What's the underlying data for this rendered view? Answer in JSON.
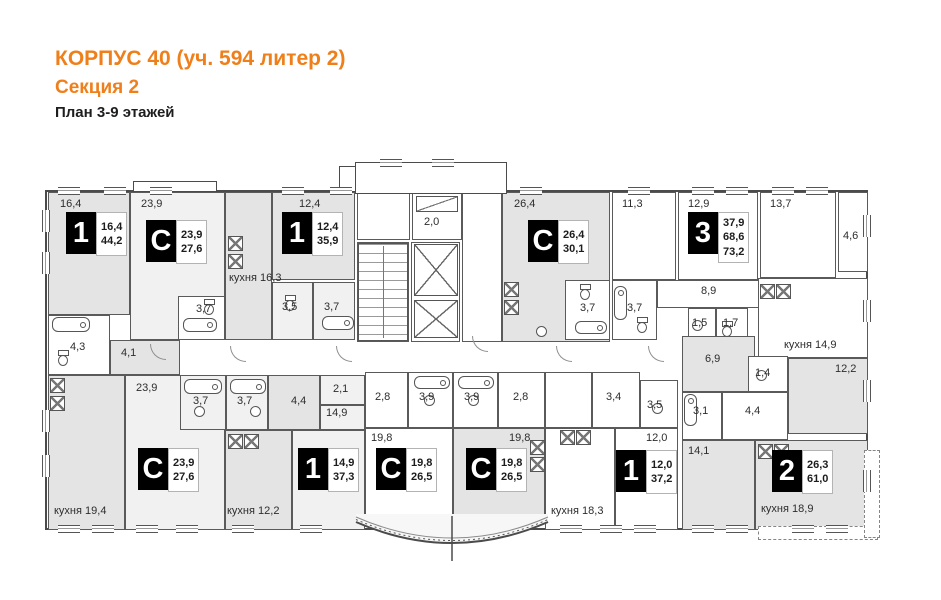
{
  "header": {
    "title": "КОРПУС 40 (уч. 594 литер 2)",
    "subtitle": "Секция 2",
    "caption": "План 3-9 этажей",
    "accent_color": "#EF7F1A"
  },
  "plan": {
    "colors": {
      "wall": "#4b4b4b",
      "room_gray": "#e4e4e4",
      "room_light": "#f1f1f1",
      "room_white": "#ffffff"
    },
    "rooms": [
      {
        "id": "bedroom-16-4",
        "label": "16,4",
        "x": 48,
        "y": 192,
        "w": 82,
        "h": 123,
        "s": "g",
        "lx": 60,
        "ly": 198
      },
      {
        "id": "studio-23-9-living",
        "label": "23,9",
        "x": 130,
        "y": 192,
        "w": 95,
        "h": 148,
        "s": "l",
        "lx": 141,
        "ly": 198
      },
      {
        "id": "studio-23-9-bath",
        "label": "3,7",
        "x": 178,
        "y": 296,
        "w": 47,
        "h": 44,
        "s": "w",
        "lx": 196,
        "ly": 303
      },
      {
        "id": "kitchen-16-3",
        "label": "кухня 16,3",
        "x": 225,
        "y": 192,
        "w": 47,
        "h": 148,
        "s": "g",
        "lx": 229,
        "ly": 272
      },
      {
        "id": "bedroom-12-4",
        "label": "12,4",
        "x": 272,
        "y": 192,
        "w": 83,
        "h": 88,
        "s": "g",
        "lx": 299,
        "ly": 198
      },
      {
        "id": "bath-3-5",
        "label": "3,5",
        "x": 272,
        "y": 282,
        "w": 41,
        "h": 58,
        "s": "l",
        "lx": 282,
        "ly": 301
      },
      {
        "id": "bath-3-7",
        "label": "3,7",
        "x": 313,
        "y": 282,
        "w": 42,
        "h": 58,
        "s": "l",
        "lx": 324,
        "ly": 301
      },
      {
        "id": "stair-vestibule",
        "label": "",
        "x": 357,
        "y": 192,
        "w": 53,
        "h": 48,
        "s": "w"
      },
      {
        "id": "balcony-2-0",
        "label": "2,0",
        "x": 412,
        "y": 192,
        "w": 50,
        "h": 48,
        "s": "w",
        "lx": 424,
        "ly": 216
      },
      {
        "id": "stairwell",
        "label": "",
        "x": 357,
        "y": 242,
        "w": 52,
        "h": 100,
        "s": "w"
      },
      {
        "id": "elevator-hall",
        "label": "",
        "x": 411,
        "y": 242,
        "w": 49,
        "h": 100,
        "s": "w"
      },
      {
        "id": "entrance-lobby",
        "label": "",
        "x": 462,
        "y": 192,
        "w": 40,
        "h": 150,
        "s": "w"
      },
      {
        "id": "studio-26-4-living",
        "label": "26,4",
        "x": 502,
        "y": 192,
        "w": 108,
        "h": 150,
        "s": "g",
        "lx": 514,
        "ly": 198
      },
      {
        "id": "studio-26-4-bath",
        "label": "3,7",
        "x": 565,
        "y": 280,
        "w": 45,
        "h": 60,
        "s": "w",
        "lx": 580,
        "ly": 302
      },
      {
        "id": "bath-3-7-apt3",
        "label": "3,7",
        "x": 612,
        "y": 280,
        "w": 45,
        "h": 60,
        "s": "w",
        "lx": 627,
        "ly": 302
      },
      {
        "id": "room-11-3",
        "label": "11,3",
        "x": 612,
        "y": 192,
        "w": 64,
        "h": 88,
        "s": "w",
        "lx": 622,
        "ly": 198
      },
      {
        "id": "room-12-9",
        "label": "12,9",
        "x": 678,
        "y": 192,
        "w": 80,
        "h": 88,
        "s": "w",
        "lx": 688,
        "ly": 198
      },
      {
        "id": "room-13-7",
        "label": "13,7",
        "x": 760,
        "y": 192,
        "w": 76,
        "h": 86,
        "s": "w",
        "lx": 770,
        "ly": 198
      },
      {
        "id": "balcony-4-6",
        "label": "4,6",
        "x": 838,
        "y": 192,
        "w": 30,
        "h": 80,
        "s": "w",
        "lx": 843,
        "ly": 230
      },
      {
        "id": "hall-8-9",
        "label": "8,9",
        "x": 657,
        "y": 280,
        "w": 115,
        "h": 28,
        "s": "w",
        "lx": 701,
        "ly": 285
      },
      {
        "id": "wc-1-5",
        "label": "1,5",
        "x": 688,
        "y": 308,
        "w": 28,
        "h": 36,
        "s": "w",
        "lx": 692,
        "ly": 317
      },
      {
        "id": "bath-1-7",
        "label": "1,7",
        "x": 716,
        "y": 308,
        "w": 32,
        "h": 36,
        "s": "w",
        "lx": 723,
        "ly": 317
      },
      {
        "id": "kitchen-14-9",
        "label": "кухня 14,9",
        "x": 758,
        "y": 278,
        "w": 110,
        "h": 80,
        "s": "w",
        "lx": 784,
        "ly": 339
      },
      {
        "id": "room-12-2",
        "label": "12,2",
        "x": 788,
        "y": 358,
        "w": 80,
        "h": 76,
        "s": "g",
        "lx": 835,
        "ly": 363
      },
      {
        "id": "kitchen-19-4",
        "label": "кухня 19,4",
        "x": 48,
        "y": 375,
        "w": 77,
        "h": 155,
        "s": "g",
        "lx": 54,
        "ly": 505
      },
      {
        "id": "bath-4-3",
        "label": "4,3",
        "x": 48,
        "y": 315,
        "w": 62,
        "h": 60,
        "s": "w",
        "lx": 70,
        "ly": 341
      },
      {
        "id": "hall-4-1",
        "label": "4,1",
        "x": 110,
        "y": 340,
        "w": 70,
        "h": 35,
        "s": "g",
        "lx": 121,
        "ly": 347
      },
      {
        "id": "studio2-23-9-living",
        "label": "23,9",
        "x": 125,
        "y": 375,
        "w": 100,
        "h": 155,
        "s": "l",
        "lx": 136,
        "ly": 382
      },
      {
        "id": "studio2-23-9-bath",
        "label": "3,7",
        "x": 180,
        "y": 375,
        "w": 46,
        "h": 55,
        "s": "l",
        "lx": 193,
        "ly": 395
      },
      {
        "id": "bath-3-7b",
        "label": "3,7",
        "x": 226,
        "y": 375,
        "w": 42,
        "h": 55,
        "s": "l",
        "lx": 237,
        "ly": 395
      },
      {
        "id": "hall-4-4",
        "label": "4,4",
        "x": 268,
        "y": 375,
        "w": 52,
        "h": 55,
        "s": "g",
        "lx": 291,
        "ly": 395
      },
      {
        "id": "niche-2-1",
        "label": "2,1",
        "x": 320,
        "y": 375,
        "w": 45,
        "h": 30,
        "s": "l",
        "lx": 333,
        "ly": 383
      },
      {
        "id": "room-14-9-upper",
        "label": "14,9",
        "x": 320,
        "y": 405,
        "w": 45,
        "h": 25,
        "s": "l",
        "lx": 326,
        "ly": 407
      },
      {
        "id": "bedroom-14-9",
        "label": "",
        "x": 292,
        "y": 430,
        "w": 73,
        "h": 100,
        "s": "l"
      },
      {
        "id": "kitchen-12-2",
        "label": "кухня 12,2",
        "x": 225,
        "y": 430,
        "w": 67,
        "h": 100,
        "s": "g",
        "lx": 227,
        "ly": 505
      },
      {
        "id": "studioA-hall",
        "label": "2,8",
        "x": 365,
        "y": 372,
        "w": 43,
        "h": 56,
        "s": "w",
        "lx": 375,
        "ly": 391
      },
      {
        "id": "studioA-bath",
        "label": "3,9",
        "x": 408,
        "y": 372,
        "w": 45,
        "h": 56,
        "s": "w",
        "lx": 419,
        "ly": 391
      },
      {
        "id": "studioA-living",
        "label": "19,8",
        "x": 365,
        "y": 428,
        "w": 88,
        "h": 96,
        "s": "w",
        "lx": 371,
        "ly": 432
      },
      {
        "id": "studioB-bath",
        "label": "3,9",
        "x": 453,
        "y": 372,
        "w": 45,
        "h": 56,
        "s": "w",
        "lx": 464,
        "ly": 391
      },
      {
        "id": "studioB-hall",
        "label": "2,8",
        "x": 498,
        "y": 372,
        "w": 47,
        "h": 56,
        "s": "w",
        "lx": 513,
        "ly": 391
      },
      {
        "id": "studioB-living",
        "label": "19,8",
        "x": 453,
        "y": 428,
        "w": 92,
        "h": 96,
        "s": "g",
        "lx": 509,
        "ly": 432
      },
      {
        "id": "apt-entry",
        "label": "",
        "x": 545,
        "y": 372,
        "w": 47,
        "h": 56,
        "s": "w"
      },
      {
        "id": "hall-3-4",
        "label": "3,4",
        "x": 592,
        "y": 372,
        "w": 48,
        "h": 56,
        "s": "w",
        "lx": 606,
        "ly": 391
      },
      {
        "id": "bath-3-5b",
        "label": "3,5",
        "x": 640,
        "y": 380,
        "w": 38,
        "h": 48,
        "s": "w",
        "lx": 647,
        "ly": 399
      },
      {
        "id": "kitchen-18-3",
        "label": "кухня 18,3",
        "x": 545,
        "y": 428,
        "w": 70,
        "h": 102,
        "s": "w",
        "lx": 551,
        "ly": 505
      },
      {
        "id": "bedroom-12-0",
        "label": "12,0",
        "x": 615,
        "y": 428,
        "w": 63,
        "h": 102,
        "s": "w",
        "lx": 646,
        "ly": 432
      },
      {
        "id": "hall-6-9",
        "label": "6,9",
        "x": 682,
        "y": 336,
        "w": 73,
        "h": 56,
        "s": "g",
        "lx": 705,
        "ly": 353
      },
      {
        "id": "wc-1-4",
        "label": "1,4",
        "x": 748,
        "y": 356,
        "w": 40,
        "h": 36,
        "s": "w",
        "lx": 755,
        "ly": 367
      },
      {
        "id": "bath-3-1",
        "label": "3,1",
        "x": 682,
        "y": 392,
        "w": 40,
        "h": 48,
        "s": "w",
        "lx": 693,
        "ly": 405
      },
      {
        "id": "hall-4-4b",
        "label": "4,4",
        "x": 722,
        "y": 392,
        "w": 66,
        "h": 48,
        "s": "w",
        "lx": 745,
        "ly": 405
      },
      {
        "id": "bedroom-14-1",
        "label": "14,1",
        "x": 682,
        "y": 440,
        "w": 73,
        "h": 90,
        "s": "g",
        "lx": 688,
        "ly": 445
      },
      {
        "id": "kitchen-18-9",
        "label": "кухня 18,9",
        "x": 755,
        "y": 440,
        "w": 113,
        "h": 90,
        "s": "g",
        "lx": 761,
        "ly": 503
      }
    ],
    "badges": [
      {
        "type": "1",
        "x": 66,
        "y": 212,
        "values": [
          "16,4",
          "44,2"
        ]
      },
      {
        "type": "С",
        "x": 146,
        "y": 220,
        "values": [
          "23,9",
          "27,6"
        ]
      },
      {
        "type": "1",
        "x": 282,
        "y": 212,
        "values": [
          "12,4",
          "35,9"
        ]
      },
      {
        "type": "С",
        "x": 528,
        "y": 220,
        "values": [
          "26,4",
          "30,1"
        ]
      },
      {
        "type": "3",
        "x": 688,
        "y": 212,
        "values": [
          "37,9",
          "68,6",
          "73,2"
        ]
      },
      {
        "type": "С",
        "x": 138,
        "y": 448,
        "values": [
          "23,9",
          "27,6"
        ]
      },
      {
        "type": "1",
        "x": 298,
        "y": 448,
        "values": [
          "14,9",
          "37,3"
        ]
      },
      {
        "type": "С",
        "x": 376,
        "y": 448,
        "values": [
          "19,8",
          "26,5"
        ]
      },
      {
        "type": "С",
        "x": 466,
        "y": 448,
        "values": [
          "19,8",
          "26,5"
        ]
      },
      {
        "type": "1",
        "x": 616,
        "y": 450,
        "values": [
          "12,0",
          "37,2"
        ]
      },
      {
        "type": "2",
        "x": 772,
        "y": 450,
        "values": [
          "26,3",
          "61,0"
        ]
      }
    ],
    "fixtures": [
      {
        "k": "stairs",
        "x": 358,
        "y": 243,
        "w": 50,
        "h": 98
      },
      {
        "k": "shaft",
        "x": 414,
        "y": 244,
        "w": 44,
        "h": 52
      },
      {
        "k": "shaft",
        "x": 414,
        "y": 300,
        "w": 44,
        "h": 38
      },
      {
        "k": "panel",
        "x": 416,
        "y": 196,
        "w": 42,
        "h": 16
      },
      {
        "k": "tub",
        "x": 183,
        "y": 318,
        "w": 34,
        "h": 14
      },
      {
        "k": "tub",
        "x": 322,
        "y": 316,
        "w": 32,
        "h": 14
      },
      {
        "k": "tub",
        "x": 575,
        "y": 321,
        "w": 32,
        "h": 13
      },
      {
        "k": "tub",
        "x": 52,
        "y": 317,
        "w": 38,
        "h": 15
      },
      {
        "k": "tub",
        "x": 184,
        "y": 379,
        "w": 38,
        "h": 15
      },
      {
        "k": "tub",
        "x": 230,
        "y": 379,
        "w": 36,
        "h": 15
      },
      {
        "k": "tub",
        "x": 414,
        "y": 376,
        "w": 36,
        "h": 13
      },
      {
        "k": "tub",
        "x": 458,
        "y": 376,
        "w": 36,
        "h": 13
      },
      {
        "k": "tubv",
        "x": 614,
        "y": 286,
        "w": 13,
        "h": 34
      },
      {
        "k": "tubv",
        "x": 684,
        "y": 394,
        "w": 13,
        "h": 32
      },
      {
        "k": "wc",
        "x": 204,
        "y": 299
      },
      {
        "k": "wc",
        "x": 285,
        "y": 295
      },
      {
        "k": "wc",
        "x": 580,
        "y": 284
      },
      {
        "k": "wc",
        "x": 637,
        "y": 317
      },
      {
        "k": "wc",
        "x": 58,
        "y": 350
      },
      {
        "k": "wc",
        "x": 722,
        "y": 321
      },
      {
        "k": "sink",
        "x": 692,
        "y": 320
      },
      {
        "k": "sink",
        "x": 194,
        "y": 406
      },
      {
        "k": "sink",
        "x": 250,
        "y": 406
      },
      {
        "k": "sink",
        "x": 424,
        "y": 395
      },
      {
        "k": "sink",
        "x": 468,
        "y": 395
      },
      {
        "k": "sink",
        "x": 652,
        "y": 403
      },
      {
        "k": "sink",
        "x": 756,
        "y": 370
      },
      {
        "k": "sink",
        "x": 536,
        "y": 326
      },
      {
        "k": "stove",
        "x": 228,
        "y": 236
      },
      {
        "k": "stove",
        "x": 228,
        "y": 254
      },
      {
        "k": "stove",
        "x": 504,
        "y": 282
      },
      {
        "k": "stove",
        "x": 504,
        "y": 300
      },
      {
        "k": "stove",
        "x": 760,
        "y": 284
      },
      {
        "k": "stove",
        "x": 776,
        "y": 284
      },
      {
        "k": "stove",
        "x": 50,
        "y": 378
      },
      {
        "k": "stove",
        "x": 50,
        "y": 396
      },
      {
        "k": "stove",
        "x": 228,
        "y": 434
      },
      {
        "k": "stove",
        "x": 244,
        "y": 434
      },
      {
        "k": "stove",
        "x": 560,
        "y": 430
      },
      {
        "k": "stove",
        "x": 576,
        "y": 430
      },
      {
        "k": "stove",
        "x": 758,
        "y": 444
      },
      {
        "k": "stove",
        "x": 774,
        "y": 444
      },
      {
        "k": "stove",
        "x": 530,
        "y": 440
      },
      {
        "k": "stove",
        "x": 530,
        "y": 457
      },
      {
        "k": "arc",
        "x": 150,
        "y": 344
      },
      {
        "k": "arc",
        "x": 230,
        "y": 346
      },
      {
        "k": "arc",
        "x": 336,
        "y": 346
      },
      {
        "k": "arc",
        "x": 472,
        "y": 336
      },
      {
        "k": "arc",
        "x": 556,
        "y": 346
      },
      {
        "k": "arc",
        "x": 648,
        "y": 346
      }
    ],
    "windows": [
      {
        "o": "h",
        "x": 58,
        "y": 187
      },
      {
        "o": "h",
        "x": 104,
        "y": 187
      },
      {
        "o": "h",
        "x": 150,
        "y": 187
      },
      {
        "o": "h",
        "x": 282,
        "y": 187
      },
      {
        "o": "h",
        "x": 330,
        "y": 187
      },
      {
        "o": "h",
        "x": 520,
        "y": 187
      },
      {
        "o": "h",
        "x": 628,
        "y": 187
      },
      {
        "o": "h",
        "x": 692,
        "y": 187
      },
      {
        "o": "h",
        "x": 726,
        "y": 187
      },
      {
        "o": "h",
        "x": 772,
        "y": 187
      },
      {
        "o": "h",
        "x": 806,
        "y": 187
      },
      {
        "o": "h",
        "x": 380,
        "y": 159
      },
      {
        "o": "h",
        "x": 432,
        "y": 159
      },
      {
        "o": "h",
        "x": 58,
        "y": 525
      },
      {
        "o": "h",
        "x": 92,
        "y": 525
      },
      {
        "o": "h",
        "x": 136,
        "y": 525
      },
      {
        "o": "h",
        "x": 176,
        "y": 525
      },
      {
        "o": "h",
        "x": 232,
        "y": 525
      },
      {
        "o": "h",
        "x": 300,
        "y": 525
      },
      {
        "o": "h",
        "x": 560,
        "y": 525
      },
      {
        "o": "h",
        "x": 600,
        "y": 525
      },
      {
        "o": "h",
        "x": 634,
        "y": 525
      },
      {
        "o": "h",
        "x": 692,
        "y": 525
      },
      {
        "o": "h",
        "x": 726,
        "y": 525
      },
      {
        "o": "h",
        "x": 792,
        "y": 525
      },
      {
        "o": "h",
        "x": 826,
        "y": 525
      },
      {
        "o": "v",
        "x": 42,
        "y": 210
      },
      {
        "o": "v",
        "x": 42,
        "y": 252
      },
      {
        "o": "v",
        "x": 42,
        "y": 410
      },
      {
        "o": "v",
        "x": 42,
        "y": 455
      },
      {
        "o": "v",
        "x": 863,
        "y": 215
      },
      {
        "o": "v",
        "x": 863,
        "y": 300
      },
      {
        "o": "v",
        "x": 863,
        "y": 380
      },
      {
        "o": "v",
        "x": 863,
        "y": 470
      }
    ]
  }
}
